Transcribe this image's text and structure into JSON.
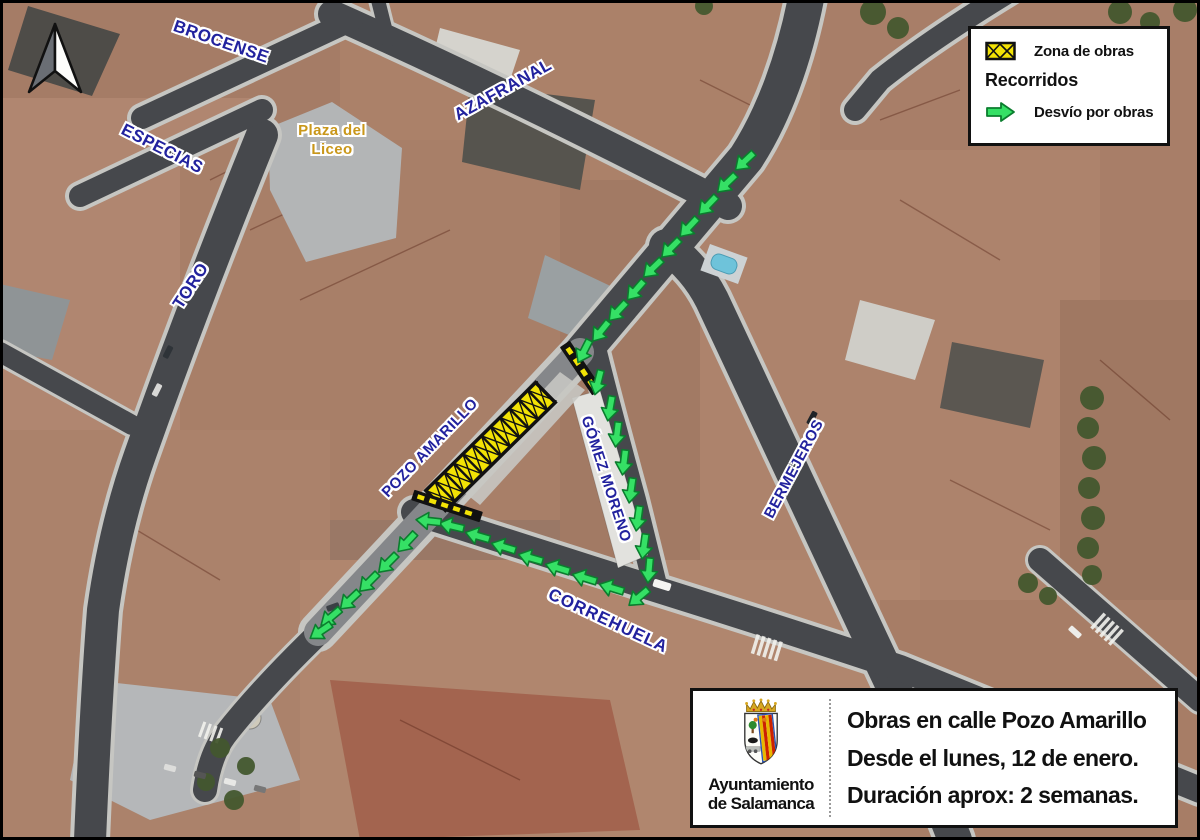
{
  "colors": {
    "street_label_blue": "#22229e",
    "plaza_label_gold": "#c9971a",
    "work_zone_yellow": "#f2e205",
    "detour_green": "#35e065",
    "detour_green_dark": "#0b7d2e"
  },
  "map": {
    "street_labels": [
      {
        "id": "brocense",
        "text": "BROCENSE"
      },
      {
        "id": "especias",
        "text": "ESPECIAS"
      },
      {
        "id": "toro",
        "text": "TORO"
      },
      {
        "id": "azafranal",
        "text": "AZAFRANAL"
      },
      {
        "id": "pozo-amarillo",
        "text": "POZO AMARILLO"
      },
      {
        "id": "gomez-moreno",
        "text": "GÓMEZ MORENO"
      },
      {
        "id": "bermejeros",
        "text": "BERMEJEROS"
      },
      {
        "id": "correhuela",
        "text": "CORREHUELA"
      }
    ],
    "place_labels": [
      {
        "id": "plaza-del-liceo",
        "line1": "Plaza del",
        "line2": "Liceo"
      }
    ]
  },
  "legend": {
    "work_zone_label": "Zona de obras",
    "routes_heading": "Recorridos",
    "detour_label": "Desvío por obras"
  },
  "info_box": {
    "org_line1": "Ayuntamiento",
    "org_line2": "de Salamanca",
    "title_line1": "Obras en calle Pozo Amarillo",
    "title_line2": "Desde el lunes, 12 de enero.",
    "title_line3": "Duración aprox: 2 semanas."
  }
}
